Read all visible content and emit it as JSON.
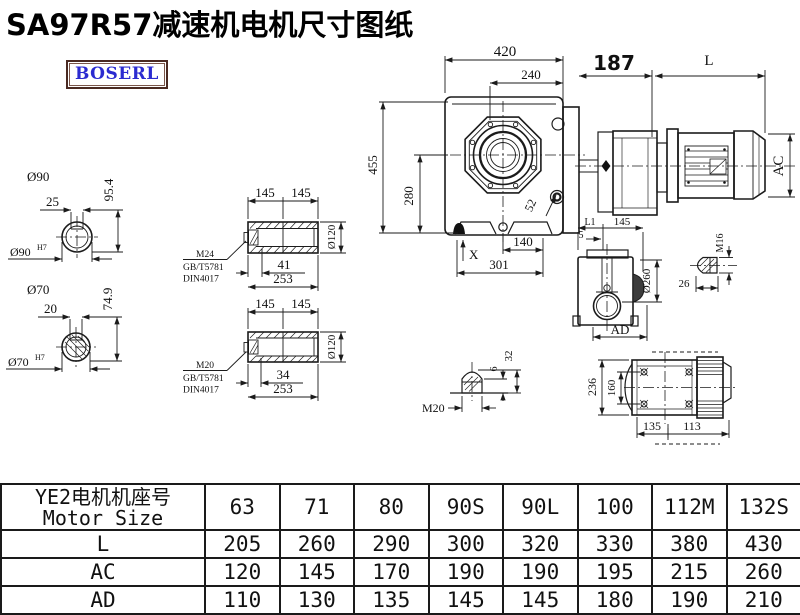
{
  "title": "SA97R57减速机电机尺寸图纸",
  "logo": {
    "text": "BOSERL"
  },
  "drawing": {
    "shaft_90": {
      "od": "Ø90",
      "key_w": "25",
      "height": "95.4",
      "bore": "Ø90",
      "tol": "H7"
    },
    "shaft_70": {
      "od": "Ø70",
      "key_w": "20",
      "height": "74.9",
      "bore": "Ø70",
      "tol": "H7"
    },
    "hollow_1": {
      "seg1": "145",
      "seg2": "145",
      "od": "Ø120",
      "screw_len": "41",
      "total": "253",
      "screw": "M24",
      "std1": "GB/T5781",
      "std2": "DIN4017"
    },
    "hollow_2": {
      "seg1": "145",
      "seg2": "145",
      "od": "Ø120",
      "screw_len": "34",
      "total": "253",
      "screw": "M20",
      "std1": "GB/T5781",
      "std2": "DIN4017"
    },
    "main": {
      "w": "420",
      "fw": "240",
      "adapter": "187",
      "motor_l": "L",
      "h": "455",
      "ch": "280",
      "bolt": "52",
      "x": "X",
      "f1": "140",
      "f2": "301",
      "ac": "AC"
    },
    "side": {
      "l1": "L1",
      "d145": "145",
      "d5": "5",
      "od": "Ø260",
      "ad": "AD"
    },
    "m16": {
      "thread": "M16",
      "len": "26"
    },
    "m20": {
      "thread": "M20",
      "d6": "6",
      "d32": "32"
    },
    "bottom": {
      "w": "236",
      "span": "160",
      "a": "135",
      "b": "113"
    }
  },
  "table": {
    "header": {
      "line1": "YE2电机机座号",
      "line2": "Motor Size"
    },
    "columns": [
      "63",
      "71",
      "80",
      "90S",
      "90L",
      "100",
      "112M",
      "132S"
    ],
    "rows": [
      {
        "label": "L",
        "values": [
          "205",
          "260",
          "290",
          "300",
          "320",
          "330",
          "380",
          "430"
        ]
      },
      {
        "label": "AC",
        "values": [
          "120",
          "145",
          "170",
          "190",
          "190",
          "195",
          "215",
          "260"
        ]
      },
      {
        "label": "AD",
        "values": [
          "110",
          "130",
          "135",
          "145",
          "145",
          "180",
          "190",
          "210"
        ]
      }
    ]
  }
}
